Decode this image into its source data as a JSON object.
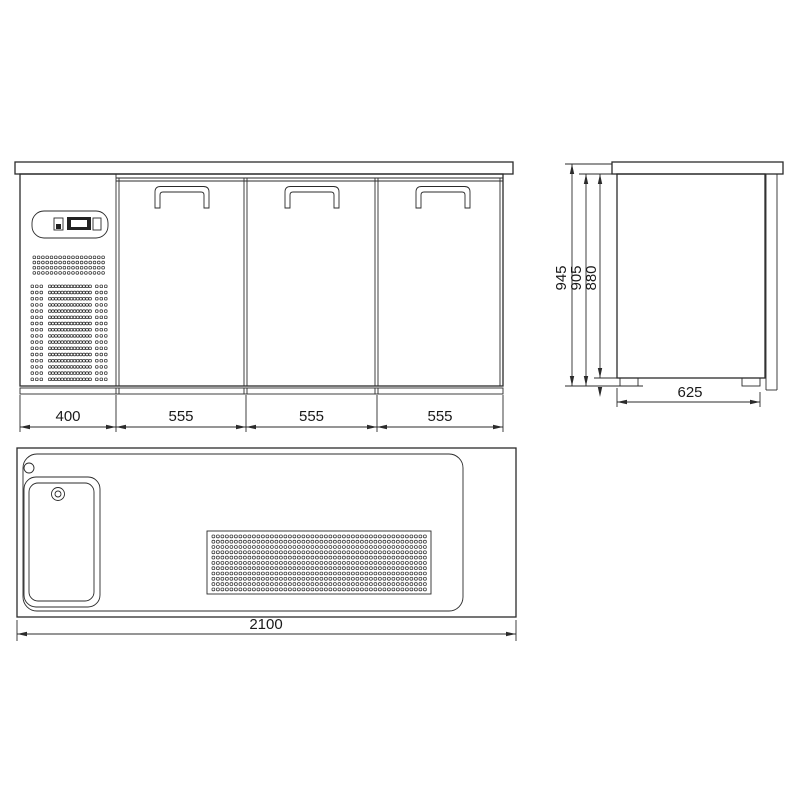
{
  "page": {
    "background": "#ffffff",
    "line_color": "#2b2b2b",
    "text_color": "#1a1a1a",
    "description": "Technical drawing of a three-door refrigerated bar counter with sink"
  },
  "views": {
    "front": {
      "dim_values": [
        "400",
        "555",
        "555",
        "555"
      ]
    },
    "side": {
      "height_dims": [
        "945",
        "905",
        "880"
      ],
      "depth_dim": "625"
    },
    "plan": {
      "width_dim": "2100"
    }
  },
  "graphics": {
    "front_grille_top_block": {
      "cols": 17,
      "rows": 4
    },
    "front_grille_main": {
      "rows": 16,
      "left_cols": 3,
      "mid_cols": 14,
      "right_cols": 3
    },
    "plan_grille": {
      "cols": 48,
      "rows": 11
    }
  }
}
